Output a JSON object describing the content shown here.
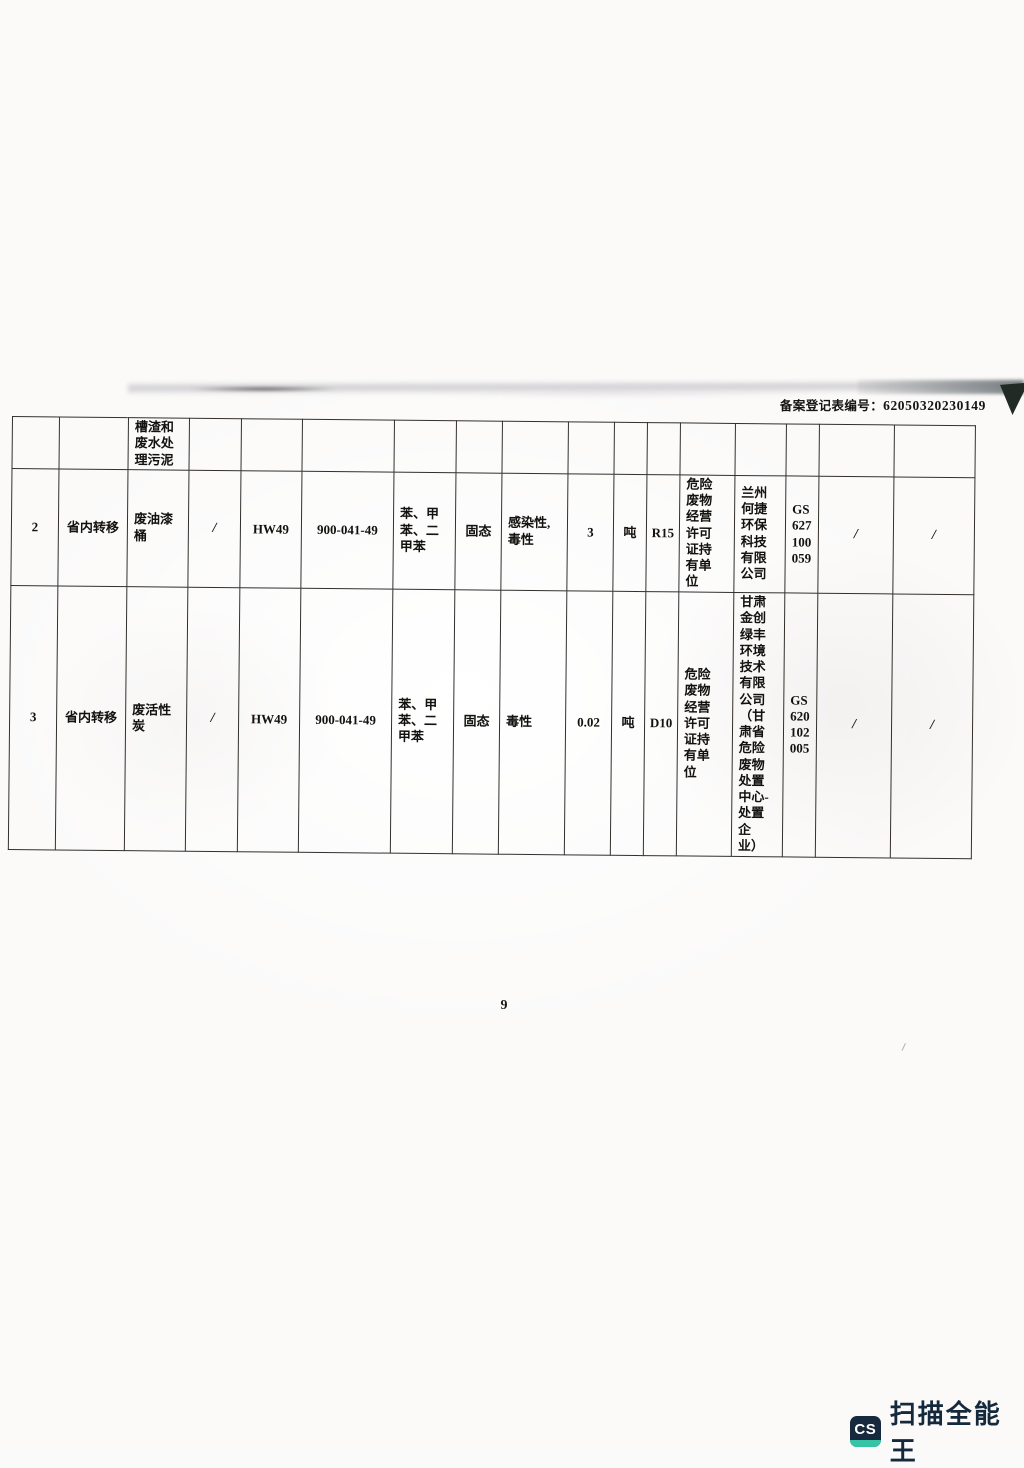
{
  "header": {
    "registration_label": "备案登记表编号：",
    "registration_number": "62050320230149"
  },
  "table": {
    "rows": [
      {
        "cells": [
          "",
          "",
          "槽渣和\n废水处\n理污泥",
          "",
          "",
          "",
          "",
          "",
          "",
          "",
          "",
          "",
          "",
          "",
          "",
          "",
          ""
        ]
      },
      {
        "cells": [
          "2",
          "省内转移",
          "废油漆\n桶",
          "/",
          "HW49",
          "900-041-49",
          "苯、甲\n苯、二\n甲苯",
          "固态",
          "感染性,\n毒性",
          "3",
          "吨",
          "R15",
          "危险\n废物\n经营\n许可\n证持\n有单\n位",
          "兰州\n何捷\n环保\n科技\n有限\n公司",
          "GS\n627\n100\n059",
          "/",
          "/"
        ]
      },
      {
        "cells": [
          "3",
          "省内转移",
          "废活性\n炭",
          "/",
          "HW49",
          "900-041-49",
          "苯、甲\n苯、二\n甲苯",
          "固态",
          "毒性",
          "0.02",
          "吨",
          "D10",
          "危险\n废物\n经营\n许可\n证持\n有单\n位",
          "甘肃\n金创\n绿丰\n环境\n技术\n有限\n公司\n（甘\n肃省\n危险\n废物\n处置\n中心-\n处置\n企\n业）",
          "GS\n620\n102\n005",
          "/",
          "/"
        ]
      }
    ]
  },
  "footer": {
    "page_number": "9"
  },
  "watermark": {
    "badge": "CS",
    "name": "扫描全能王",
    "badge_color": "#16293d",
    "accent_color": "#36c4a4"
  }
}
